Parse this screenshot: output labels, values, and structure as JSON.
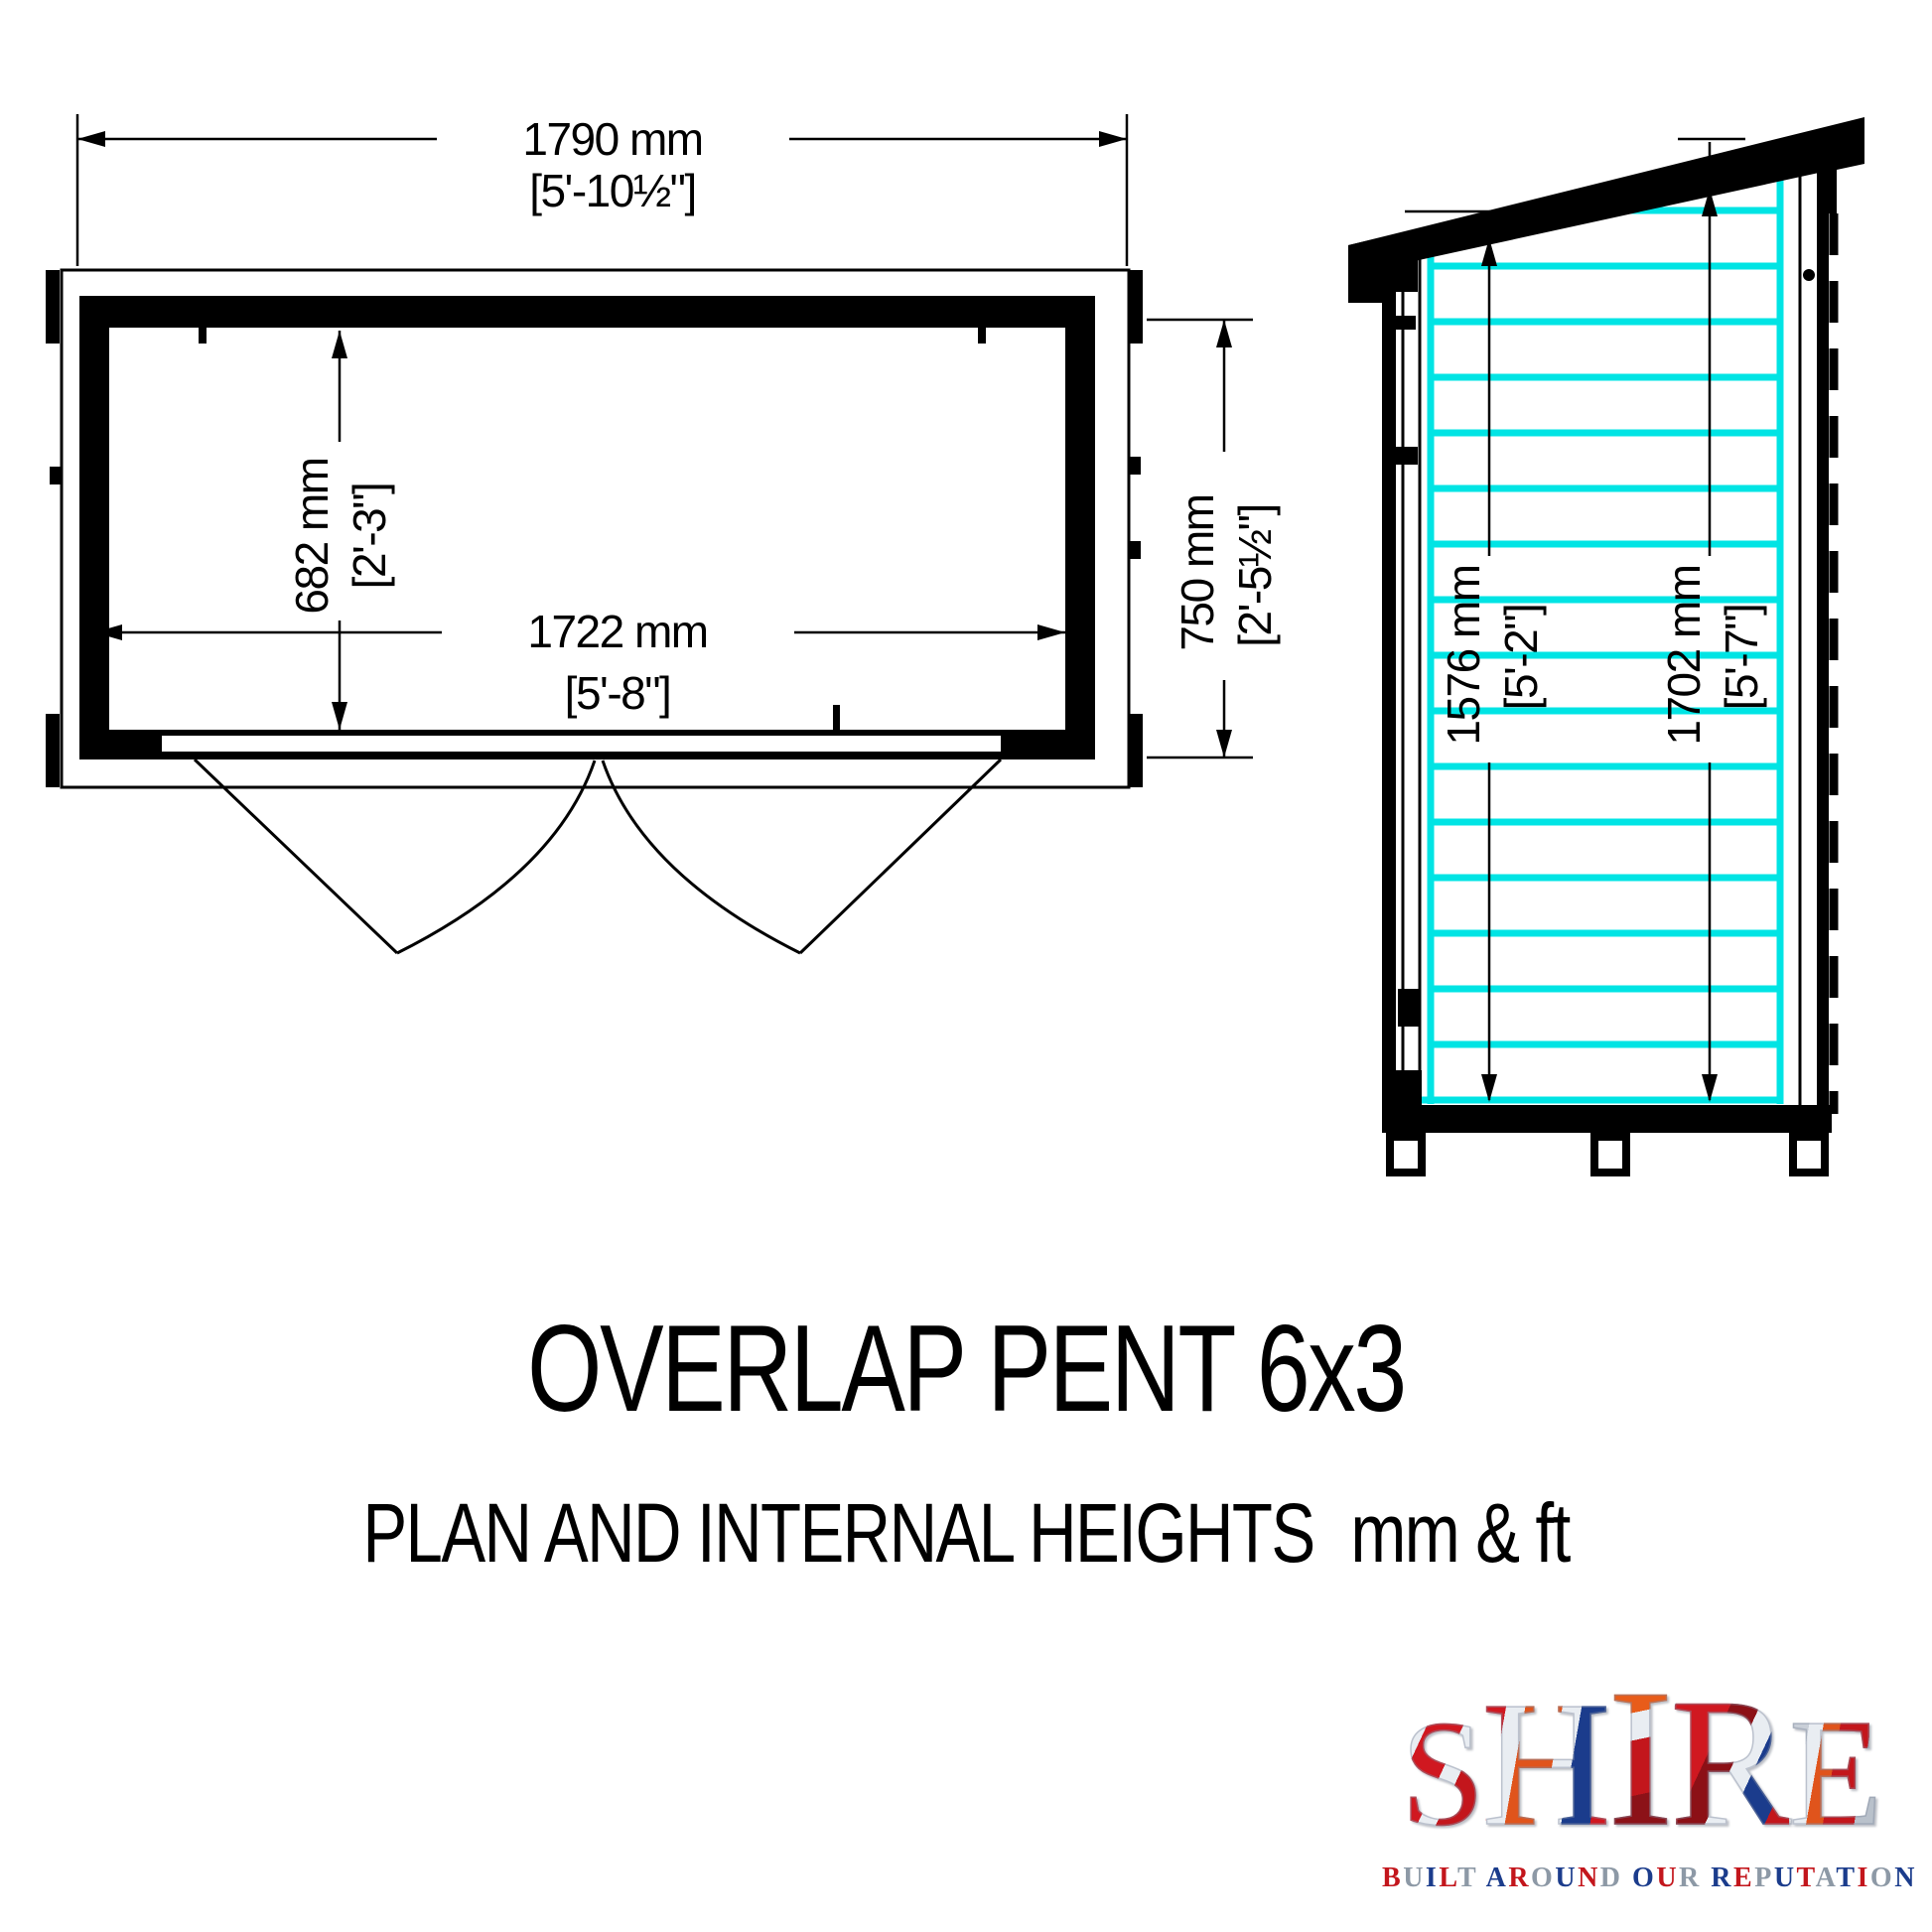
{
  "title": "OVERLAP PENT 6x3",
  "subtitle": "PLAN AND INTERNAL HEIGHTS",
  "subtitle_units": "mm & ft",
  "plan_view": {
    "overall_width_mm": "1790 mm",
    "overall_width_ft": "[5'-10½\"]",
    "internal_width_mm": "1722 mm",
    "internal_width_ft": "[5'-8\"]",
    "internal_depth_mm": "682 mm",
    "internal_depth_ft": "[2'-3\"]",
    "overall_depth_mm": "750 mm",
    "overall_depth_ft": "[2'-5½\"]"
  },
  "side_view": {
    "front_internal_height_mm": "1576 mm",
    "front_internal_height_ft": "[5'-2\"]",
    "rear_internal_height_mm": "1702 mm",
    "rear_internal_height_ft": "[5'-7\"]"
  },
  "logo": {
    "brand": "SHIRE",
    "tagline": "BUILT AROUND OUR REPUTATION"
  },
  "colors": {
    "cladding": "#00e4e4",
    "ink": "#000000",
    "logo_red": "#c3161c",
    "logo_blue": "#1b3c8c",
    "logo_silver": "#8d99a6"
  }
}
